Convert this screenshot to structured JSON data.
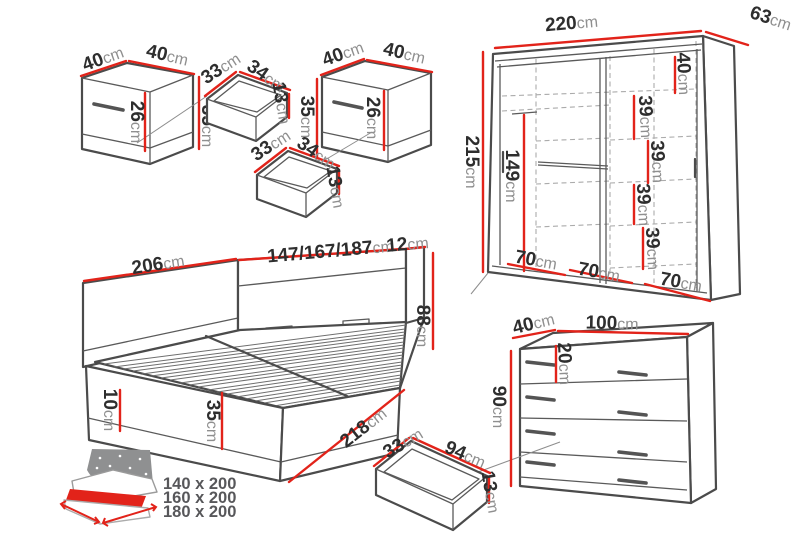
{
  "colors": {
    "dimension_red": "#e2231a",
    "outline_gray": "#4b4b4b",
    "dashed_gray": "#ababab"
  },
  "nightstand_left": {
    "depth": {
      "v": "40",
      "u": "cm"
    },
    "width": {
      "v": "40",
      "u": "cm"
    },
    "front_height": {
      "v": "26",
      "u": "cm"
    },
    "height": {
      "v": "35",
      "u": "cm"
    }
  },
  "nightstand_left_drawer": {
    "width": {
      "v": "33",
      "u": "cm"
    },
    "depth": {
      "v": "34",
      "u": "cm"
    },
    "height": {
      "v": "13",
      "u": "cm"
    }
  },
  "nightstand_right": {
    "depth": {
      "v": "40",
      "u": "cm"
    },
    "width": {
      "v": "40",
      "u": "cm"
    },
    "front_height": {
      "v": "26",
      "u": "cm"
    },
    "height": {
      "v": "35",
      "u": "cm"
    }
  },
  "nightstand_right_drawer": {
    "width": {
      "v": "33",
      "u": "cm"
    },
    "depth": {
      "v": "34",
      "u": "cm"
    },
    "height": {
      "v": "13",
      "u": "cm"
    }
  },
  "wardrobe": {
    "width": {
      "v": "220",
      "u": "cm"
    },
    "depth": {
      "v": "63",
      "u": "cm"
    },
    "height": {
      "v": "215",
      "u": "cm"
    },
    "interior_height": {
      "v": "149",
      "u": "cm"
    },
    "top_shelf": {
      "v": "40",
      "u": "cm"
    },
    "shelf_1": {
      "v": "39",
      "u": "cm"
    },
    "shelf_2": {
      "v": "39",
      "u": "cm"
    },
    "shelf_3": {
      "v": "39",
      "u": "cm"
    },
    "shelf_4": {
      "v": "39",
      "u": "cm"
    },
    "section_1": {
      "v": "70",
      "u": "cm"
    },
    "section_2": {
      "v": "70",
      "u": "cm"
    },
    "section_3": {
      "v": "70",
      "u": "cm"
    }
  },
  "bed": {
    "total_width": {
      "v": "206",
      "u": "cm"
    },
    "mattress_widths": {
      "v": "147/167/187",
      "u": "cm"
    },
    "headboard_depth": {
      "v": "12",
      "u": "cm"
    },
    "headboard_height": {
      "v": "88",
      "u": "cm"
    },
    "plinth_height": {
      "v": "10",
      "u": "cm"
    },
    "side_height": {
      "v": "35",
      "u": "cm"
    },
    "length": {
      "v": "218",
      "u": "cm"
    }
  },
  "chest": {
    "depth": {
      "v": "40",
      "u": "cm"
    },
    "width": {
      "v": "100",
      "u": "cm"
    },
    "top_drawer_height": {
      "v": "20",
      "u": "cm"
    },
    "height": {
      "v": "90",
      "u": "cm"
    }
  },
  "chest_drawer": {
    "width": {
      "v": "33",
      "u": "cm"
    },
    "length": {
      "v": "94",
      "u": "cm"
    },
    "height": {
      "v": "13",
      "u": "cm"
    }
  },
  "legend": {
    "sizes": [
      "140 x 200",
      "160 x 200",
      "180 x 200"
    ]
  }
}
